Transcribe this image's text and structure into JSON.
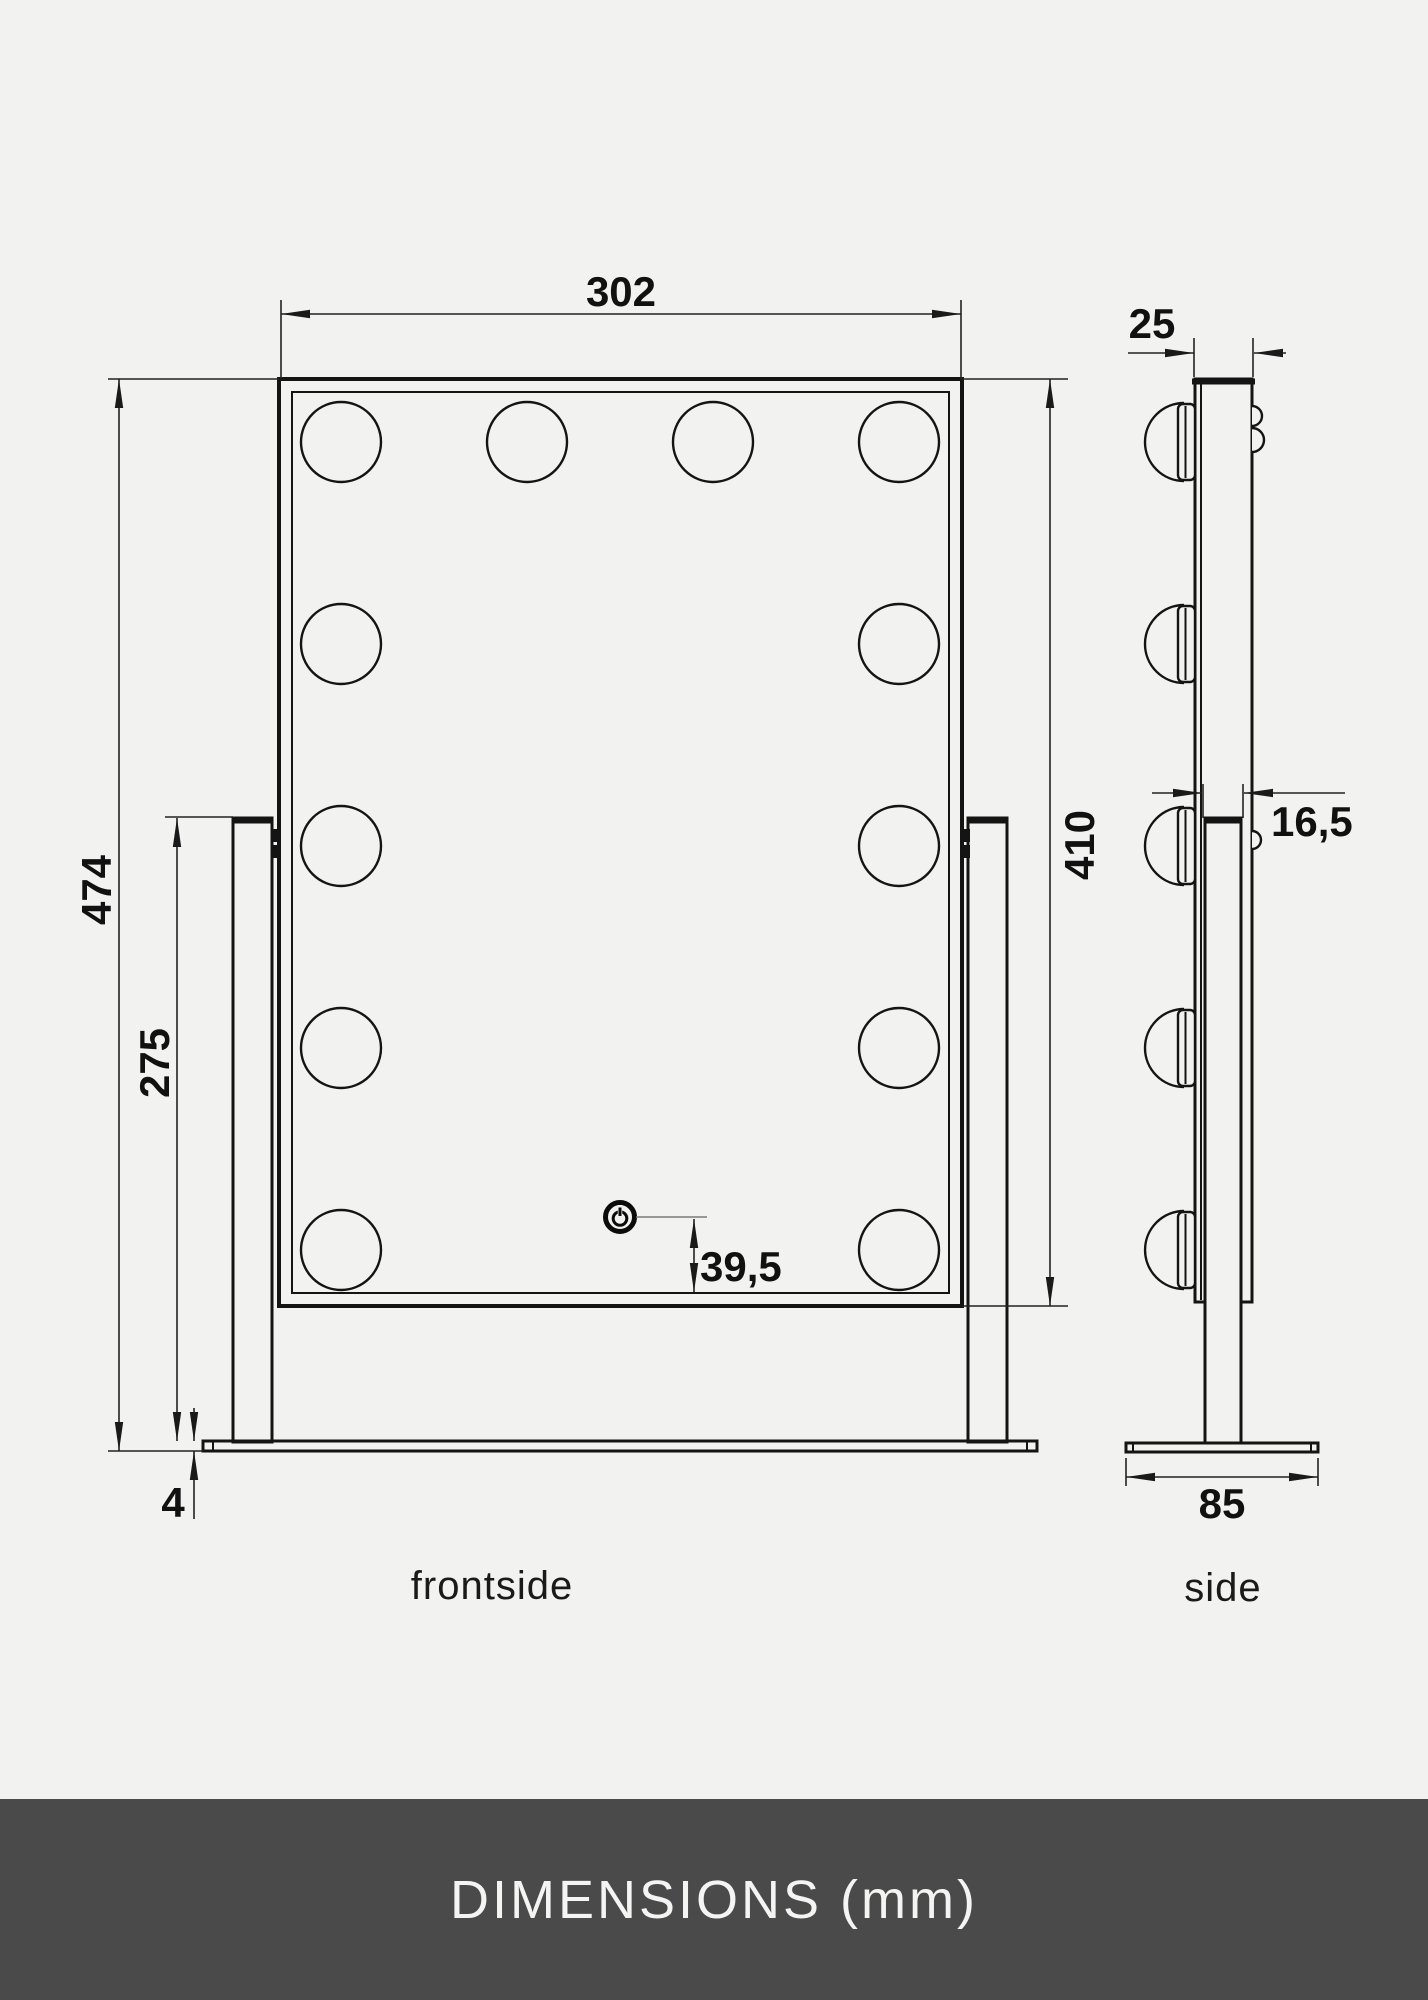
{
  "page": {
    "background_color": "#f2f2f1",
    "line_color": "#141414",
    "units": "mm"
  },
  "footer": {
    "title": "DIMENSIONS (mm)",
    "background_color": "#4a4a4b",
    "text_color": "#f4f4f3"
  },
  "icons": {
    "power": "power-icon"
  },
  "views": {
    "front": {
      "label": "frontside",
      "bulb_count": 12,
      "dimensions": {
        "width": "302",
        "total_height": "474",
        "stand_height": "275",
        "base_thickness": "4",
        "mirror_height": "410",
        "power_button_offset": "39,5"
      }
    },
    "side": {
      "label": "side",
      "bulb_count": 5,
      "dimensions": {
        "depth": "25",
        "stand_thickness": "16,5",
        "base_depth": "85"
      }
    }
  }
}
